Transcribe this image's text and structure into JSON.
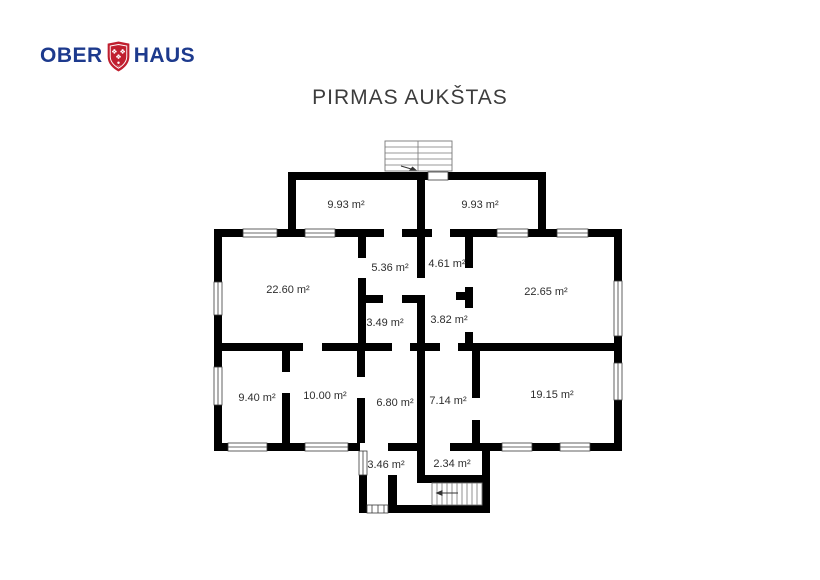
{
  "logo": {
    "ober": "OBER",
    "haus": "HAUS",
    "text_color": "#1d3a8d",
    "shield_color": "#c01f2f"
  },
  "title": "PIRMAS AUKŠTAS",
  "plan": {
    "wall_color": "#000000",
    "rooms": [
      {
        "label": "9.93 m²"
      },
      {
        "label": "9.93 m²"
      },
      {
        "label": "22.60 m²"
      },
      {
        "label": "5.36 m²"
      },
      {
        "label": "4.61 m²"
      },
      {
        "label": "22.65 m²"
      },
      {
        "label": "3.49 m²"
      },
      {
        "label": "3.82 m²"
      },
      {
        "label": "9.40 m²"
      },
      {
        "label": "10.00 m²"
      },
      {
        "label": "6.80 m²"
      },
      {
        "label": "7.14 m²"
      },
      {
        "label": "19.15 m²"
      },
      {
        "label": "3.46 m²"
      },
      {
        "label": "2.34 m²"
      }
    ],
    "elements": {
      "top_staircase": "exterior-staircase",
      "bottom_staircase": "interior-staircase",
      "windows": "double-line-window",
      "entrance_steps": "entry-steps"
    }
  }
}
